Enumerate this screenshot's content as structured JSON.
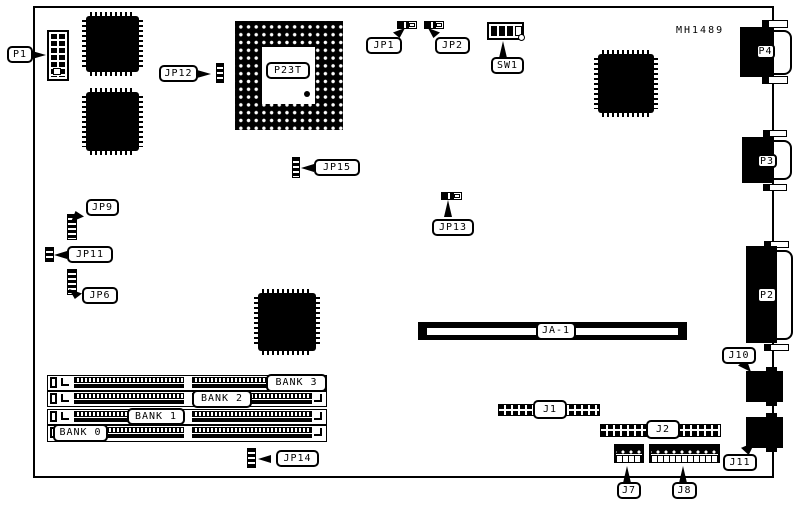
{
  "board": {
    "part_number": "MH1489"
  },
  "callouts": {
    "p1": "P1",
    "jp12": "JP12",
    "p23t": "P23T",
    "jp1": "JP1",
    "jp2": "JP2",
    "sw1": "SW1",
    "p4": "P4",
    "p3": "P3",
    "p2": "P2",
    "jp15": "JP15",
    "jp9": "JP9",
    "jp11": "JP11",
    "jp6": "JP6",
    "jp13": "JP13",
    "ja1": "JA-1",
    "j10": "J10",
    "j11": "J11",
    "j1": "J1",
    "j2": "J2",
    "j7": "J7",
    "j8": "J8",
    "jp14": "JP14",
    "bank0": "BANK 0",
    "bank1": "BANK 1",
    "bank2": "BANK 2",
    "bank3": "BANK 3"
  },
  "colors": {
    "ink": "#000000",
    "paper": "#ffffff"
  }
}
